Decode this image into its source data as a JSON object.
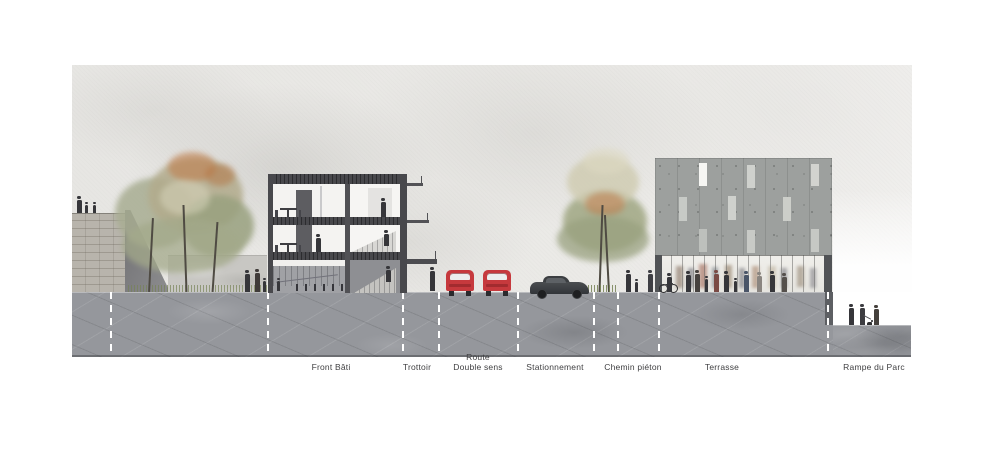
{
  "drawing": {
    "type": "street cross-section / elevation, watercolor architectural rendering",
    "language": "French"
  },
  "zones": [
    {
      "label": "Front Bâti"
    },
    {
      "label": "Trottoir"
    },
    {
      "label": "Route\nDouble sens"
    },
    {
      "label": "Stationnement"
    },
    {
      "label": "Chemin piéton"
    },
    {
      "label": "Terrasse"
    },
    {
      "label": "Rampe du Parc"
    }
  ],
  "dividers_x": [
    110,
    267,
    402,
    438,
    517,
    593,
    617,
    658,
    827
  ],
  "palette": {
    "paper": "#ffffff",
    "sky_wash": "#eae9e6",
    "ground_section": "#95979c",
    "stone_wall": "#b8b4ac",
    "left_building_frame": "#48484c",
    "right_building_facade": "#9da09e",
    "car_red": "#c6393d",
    "car_dark": "#3a3d40",
    "tree_green": "#a4aa8b",
    "tree_autumn": "#bd7f50",
    "figure_silhouette": "#36363a",
    "divider_line": "#ffffff",
    "label_text": "#3f3f41"
  }
}
